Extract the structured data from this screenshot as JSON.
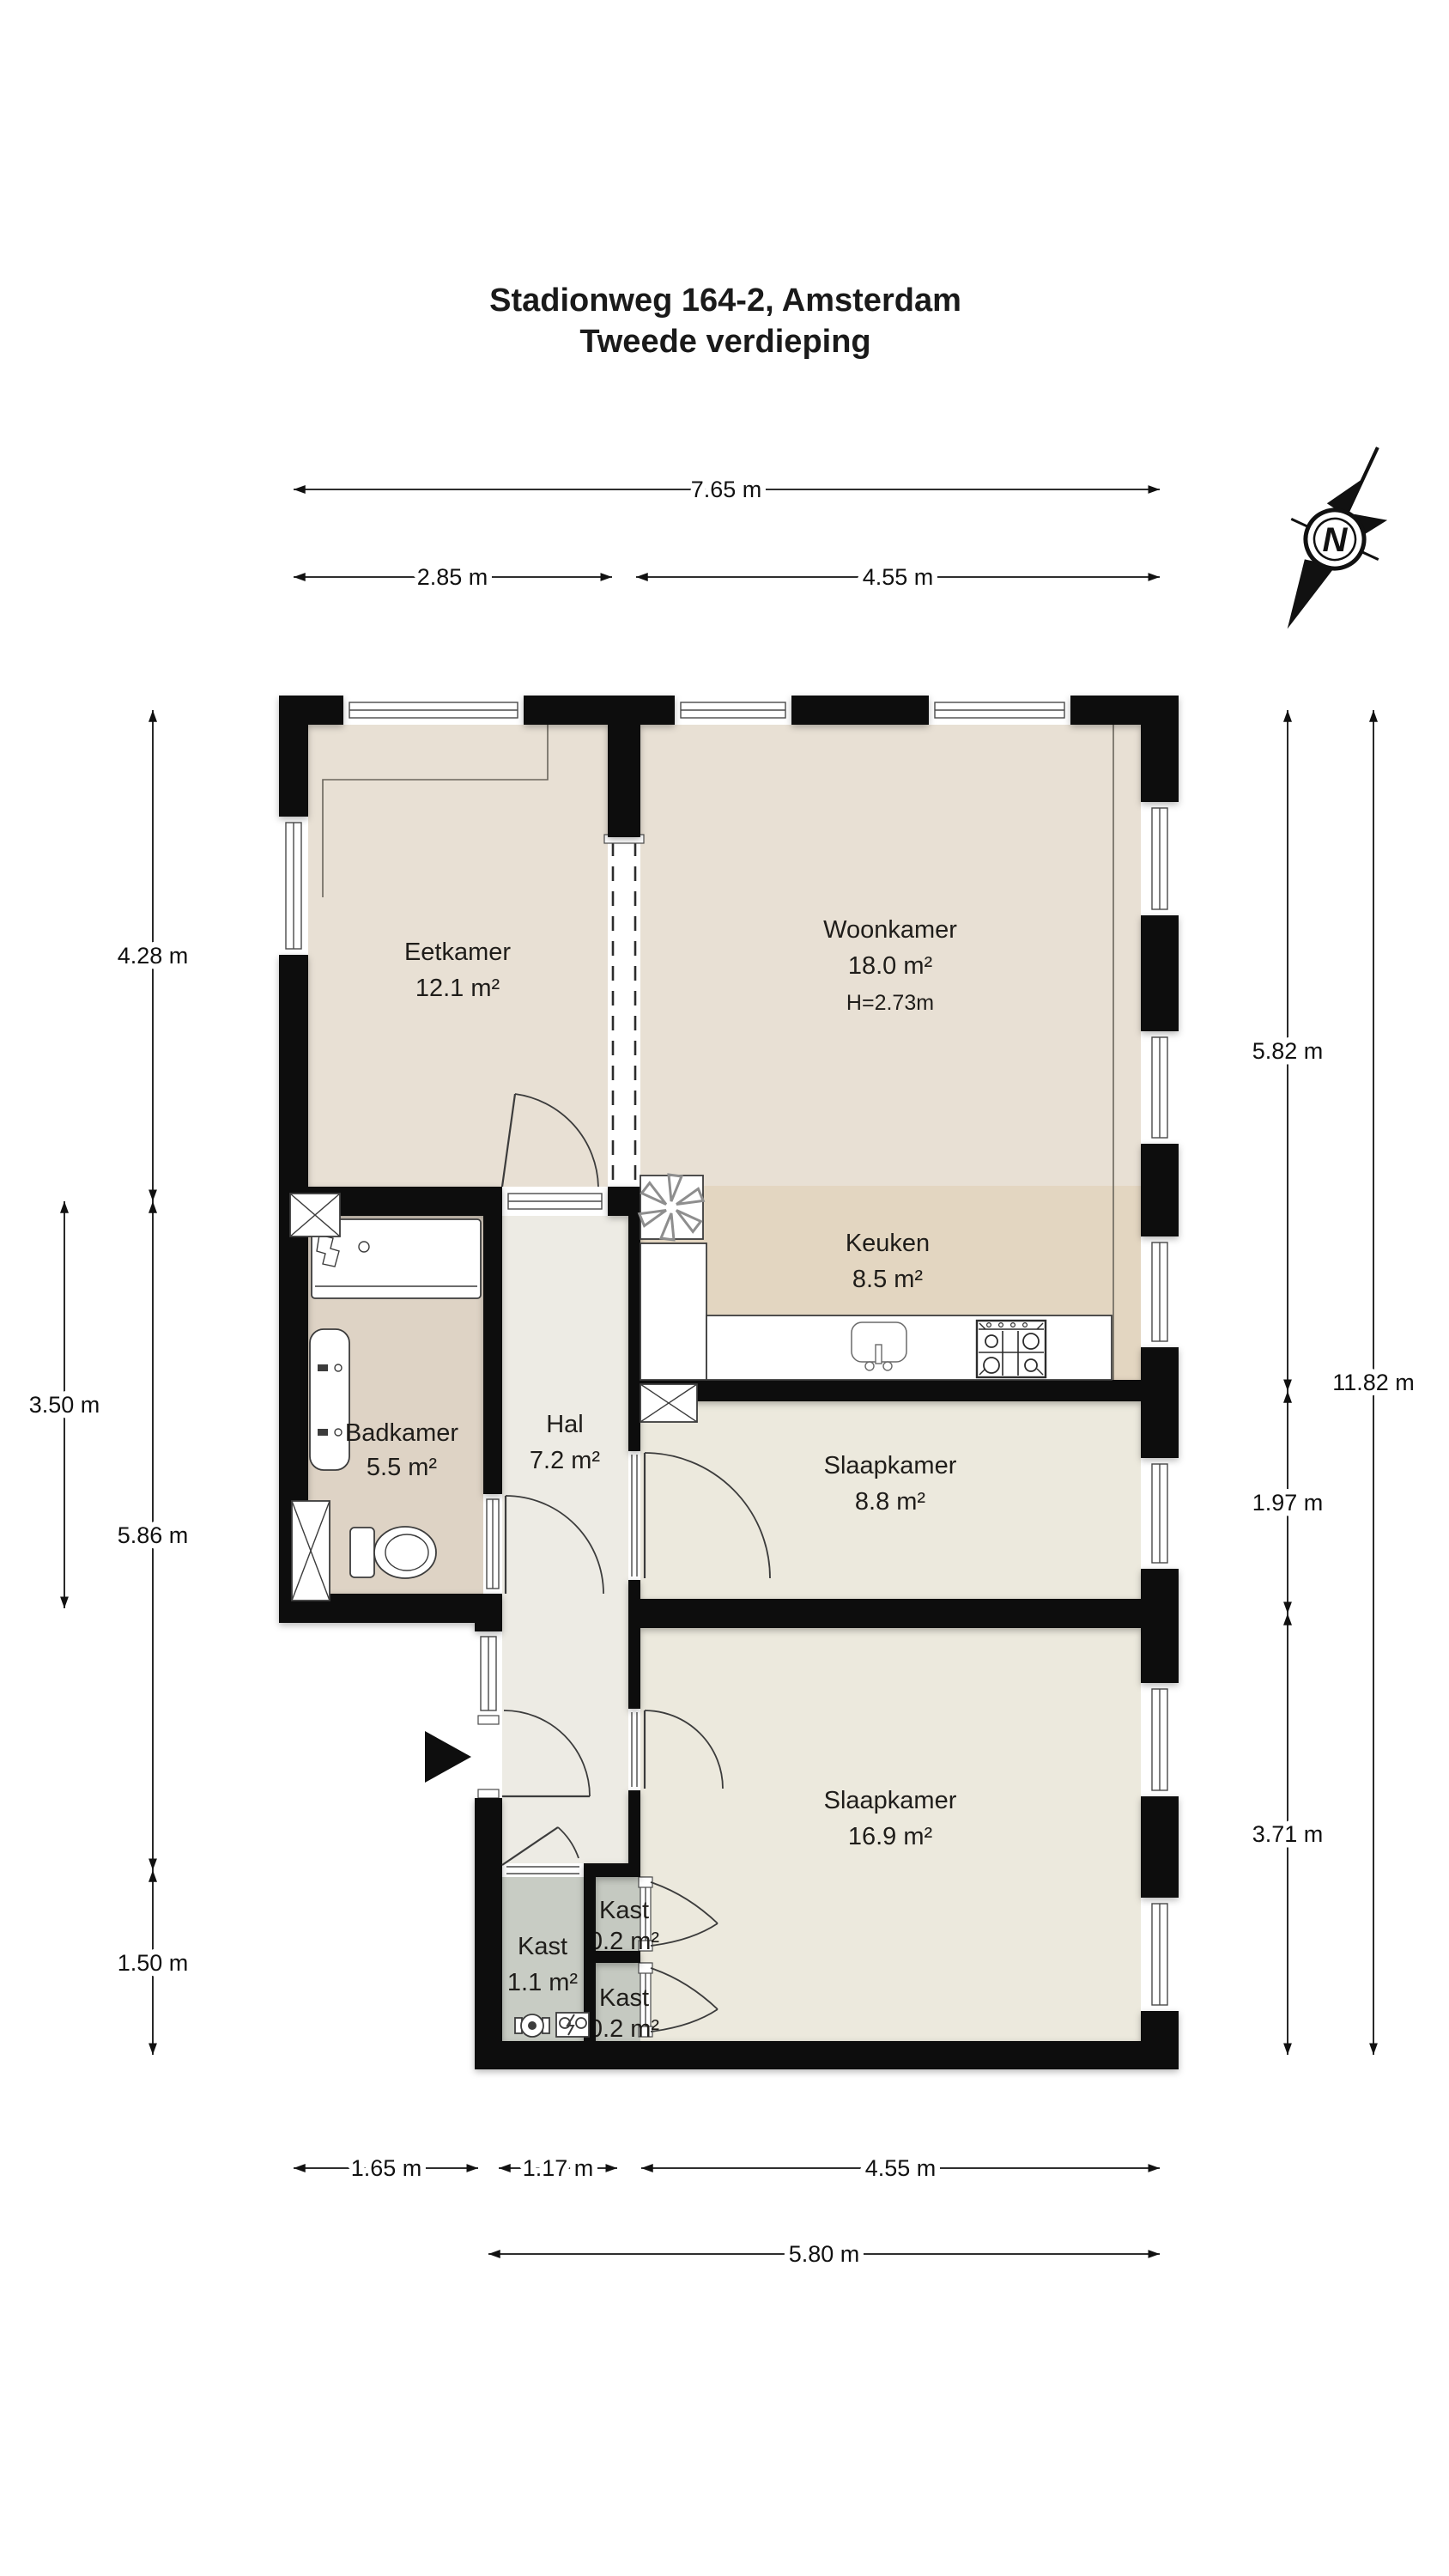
{
  "title": {
    "line1": "Stadionweg 164-2, Amsterdam",
    "line2": "Tweede verdieping"
  },
  "compass": {
    "label": "N"
  },
  "rooms": [
    {
      "id": "eetkamer",
      "name": "Eetkamer",
      "area": "12.1 m²"
    },
    {
      "id": "woonkamer",
      "name": "Woonkamer",
      "area": "18.0 m²",
      "ceiling_height": "H=2.73m"
    },
    {
      "id": "keuken",
      "name": "Keuken",
      "area": "8.5 m²"
    },
    {
      "id": "badkamer",
      "name": "Badkamer",
      "area": "5.5 m²"
    },
    {
      "id": "hal",
      "name": "Hal",
      "area": "7.2 m²"
    },
    {
      "id": "slaapkamer-1",
      "name": "Slaapkamer",
      "area": "8.8 m²"
    },
    {
      "id": "slaapkamer-2",
      "name": "Slaapkamer",
      "area": "16.9 m²"
    },
    {
      "id": "kast-hal",
      "name": "Kast",
      "area": "1.1 m²"
    },
    {
      "id": "kast-boven",
      "name": "Kast",
      "area": "0.2 m²"
    },
    {
      "id": "kast-onder",
      "name": "Kast",
      "area": "0.2 m²"
    }
  ],
  "dimensions": {
    "top_total": "7.65 m",
    "top_left": "2.85 m",
    "top_right": "4.55 m",
    "left_upper": "4.28 m",
    "left_outer": "3.50 m",
    "left_middle": "5.86 m",
    "left_lower": "1.50 m",
    "right_upper": "5.82 m",
    "right_middle": "1.97 m",
    "right_lower": "3.71 m",
    "right_total": "11.82 m",
    "bottom_left": "1.65 m",
    "bottom_hall": "1.17 m",
    "bottom_right": "4.55 m",
    "bottom_total": "5.80 m"
  },
  "icons": {
    "compass": "north-arrow-icon",
    "ventilation": "fan-icon",
    "entrance": "entrance-arrow-icon",
    "shaft": "crossed-shaft-icon",
    "meters": "utility-meter-icons"
  },
  "colors": {
    "wall": "#0e0e0e",
    "floor_living": "#e8e0d4",
    "floor_kitchen": "#e3d6c1",
    "floor_bath": "#ded3c5",
    "floor_hall": "#edebe4",
    "floor_bedroom": "#ece9dd",
    "floor_closet": "#c8ccc4",
    "background": "#ffffff"
  }
}
